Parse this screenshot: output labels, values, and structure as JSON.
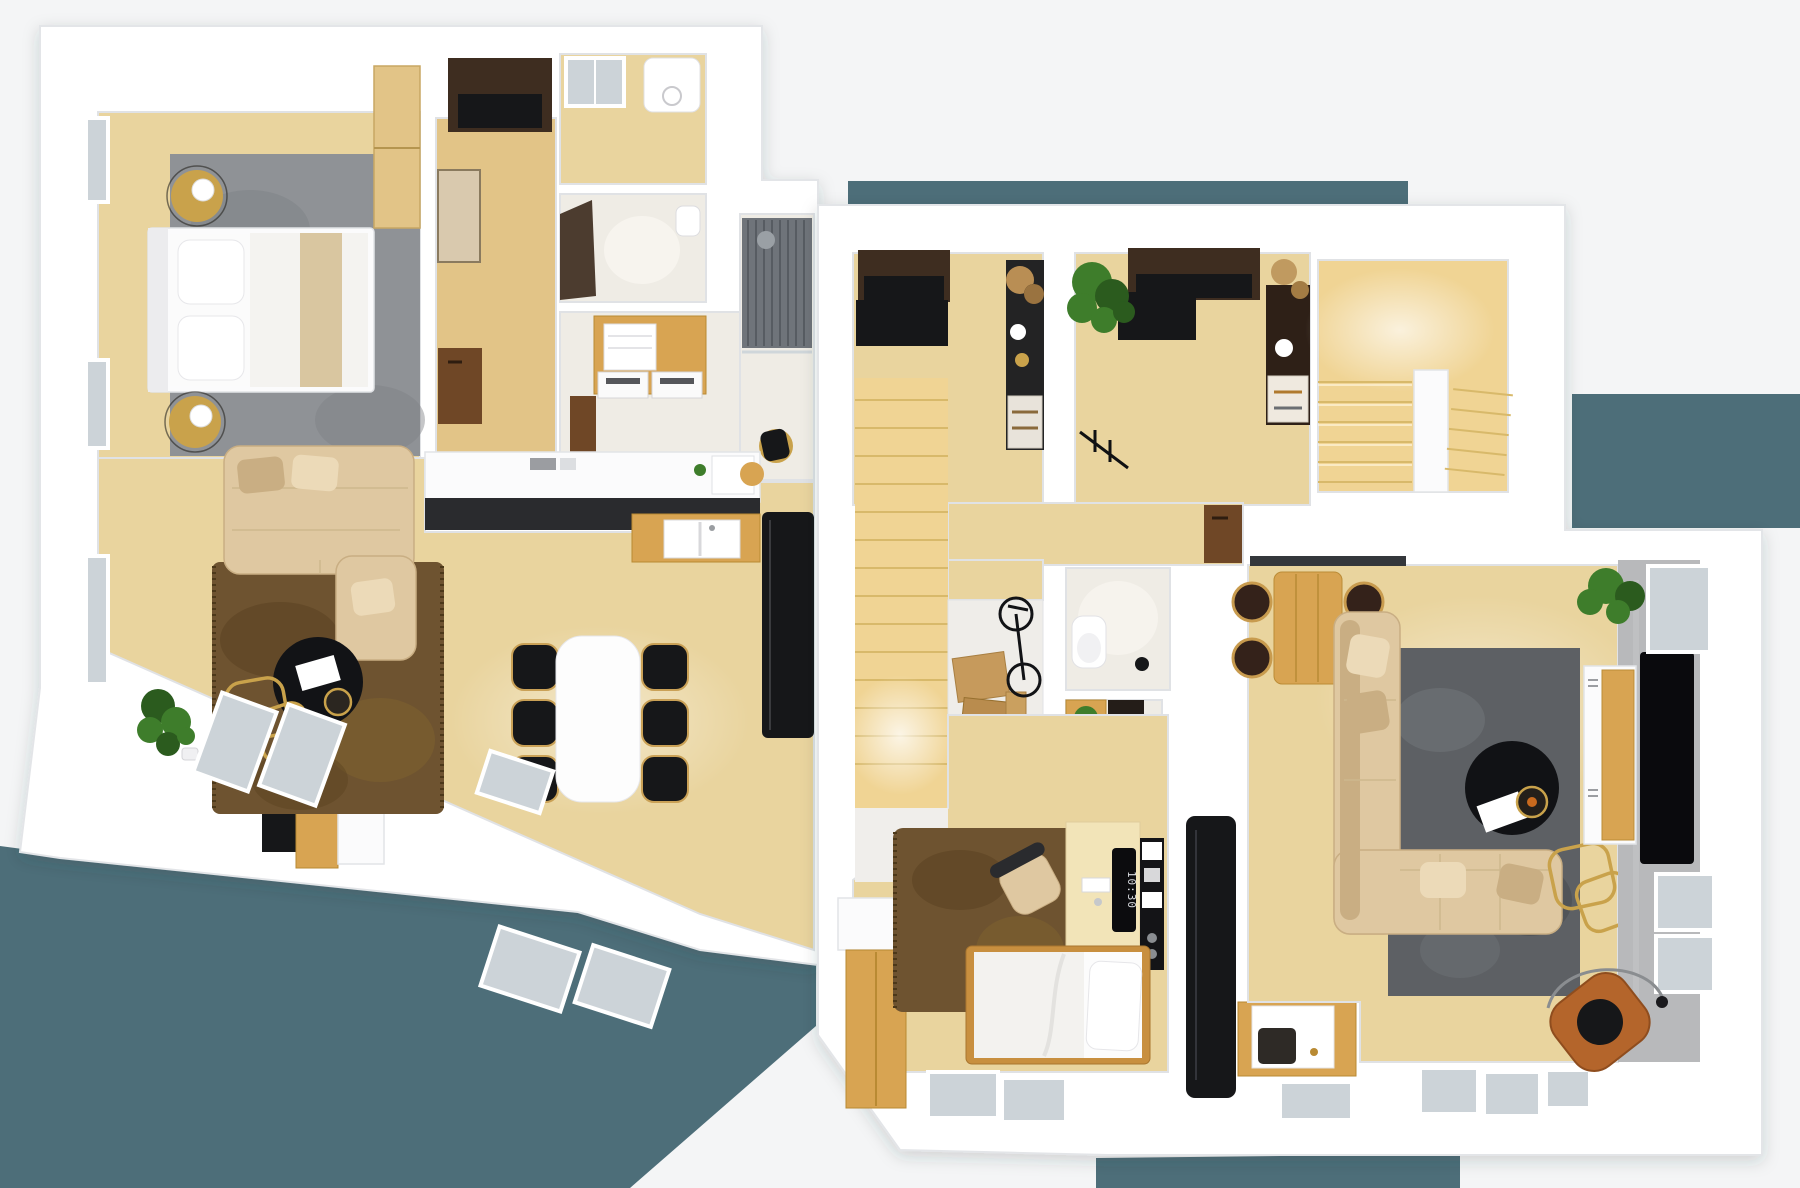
{
  "meta": {
    "type": "3d-floor-plan-render",
    "view": "top-down dollhouse view",
    "description": "Photorealistic top-down 3D floor plan render of two furnished apartment levels on a white backdrop with slate-teal ground showing at the lower-left, top strip and bottom edges"
  },
  "scene": {
    "monitor_clock": "10:30",
    "units": [
      {
        "id": "left-apartment",
        "rooms": [
          {
            "name": "bedroom",
            "furniture": [
              "double bed with white bedding and beige runner",
              "grey area rug",
              "two round gold nightstands with white table lamps",
              "tall timber wardrobe",
              "two windows in left wall"
            ]
          },
          {
            "name": "entry-hall",
            "furniture": [
              "dark built-in wardrobe",
              "leaning wall mirror",
              "walnut cabinet"
            ]
          },
          {
            "name": "utility-room",
            "furniture": [
              "skylight",
              "white water heater"
            ]
          },
          {
            "name": "wc",
            "furniture": [
              "dark door",
              "small washbasin"
            ]
          },
          {
            "name": "laundry",
            "furniture": [
              "timber counter with washer and dryer",
              "white towel stack",
              "walnut door"
            ]
          },
          {
            "name": "shower-room",
            "furniture": [
              "slatted shower wall with rain head",
              "glass screen",
              "gold stool with black towel"
            ]
          },
          {
            "name": "kitchen",
            "furniture": [
              "white counter with black worktop",
              "timber splashback with double white sink",
              "counter decor and picture frame",
              "tall black fridge column"
            ]
          },
          {
            "name": "living-dining",
            "furniture": [
              "beige L-shaped sofa with cushions",
              "brown shaggy rug",
              "round black coffee table with gold tray",
              "gold nesting side tables",
              "TV wall unit with black TV",
              "white dining table with six black chairs",
              "potted plant",
              "window"
            ]
          },
          {
            "name": "terrace-band",
            "furniture": [
              "glass floor panels"
            ]
          }
        ]
      },
      {
        "id": "right-apartment",
        "rooms": [
          {
            "name": "dressing-room-left",
            "furniture": [
              "dark wardrobe",
              "black rug",
              "black shelf column with plant, vase and towel drawers"
            ]
          },
          {
            "name": "dressing-room-right",
            "furniture": [
              "dark wardrobe",
              "black rug",
              "walnut shelf column with dried flowers, jug and towel drawers",
              "large potted plant",
              "black clothes rail"
            ]
          },
          {
            "name": "staircase-room",
            "furniture": [
              "U-shaped timber stair with white spine wall",
              "warm light glow"
            ]
          },
          {
            "name": "hallway",
            "furniture": [
              "straight timber stair to lower level",
              "walnut sideboard",
              "dark balustrade edge"
            ]
          },
          {
            "name": "wc",
            "furniture": [
              "toilet",
              "round beige mat",
              "black bin"
            ]
          },
          {
            "name": "pantry",
            "furniture": [
              "timber crate shelf with greens",
              "dark wall panel",
              "white bench"
            ]
          },
          {
            "name": "under-stair-storage",
            "furniture": [
              "cardboard boxes",
              "bicycle"
            ]
          },
          {
            "name": "bedroom",
            "furniture": [
              "single bed with timber frame and white duvet",
              "brown shaggy rug",
              "timber wardrobe with white counter",
              "desk with keyboard and portrait monitor",
              "beige desk chair",
              "black wall shelf unit"
            ]
          },
          {
            "name": "bathroom",
            "furniture": [
              "tall black cabinet column",
              "timber vanity with white basin"
            ]
          },
          {
            "name": "living-dining",
            "furniture": [
              "timber dining table with four spindle chairs",
              "dark grey area rug",
              "beige L-shaped sofa with pillows",
              "round black coffee table with gold tray and papers",
              "gold nesting side tables",
              "white-and-timber TV sideboard",
              "black TV on concrete feature wall",
              "corner plant",
              "cognac leather armchair with arc floor lamp",
              "three windows"
            ]
          },
          {
            "name": "terrace-band",
            "furniture": [
              "glass floor panels"
            ]
          }
        ]
      }
    ]
  },
  "colors": {
    "background": "#f4f5f6",
    "teal": "#4d6e79",
    "wall": "#ffffff",
    "cream": "#efece5",
    "wood-light": "#e9d49e",
    "wood-pale": "#f2e4b8",
    "wood-warm": "#e2c487",
    "wood-gold": "#d8a452",
    "wood-stair": "#f0d494",
    "walnut": "#6f4726",
    "wood-dark": "#3e2d20",
    "black": "#161719",
    "charcoal": "#2a2b2e",
    "rug-grey": "#8f9296",
    "rug-grey-dark": "#5d6064",
    "rug-brown": "#6e5330",
    "sofa": "#dfc8a1",
    "sofa-dark": "#c9ae83",
    "white-furn": "#fbfbfc",
    "glass": "#ccd3d8",
    "concrete": "#b8b9bb",
    "plant": "#3e7d2b",
    "plant-dark": "#2b5b1e",
    "gold": "#c9a24b",
    "leather": "#b4652b"
  }
}
